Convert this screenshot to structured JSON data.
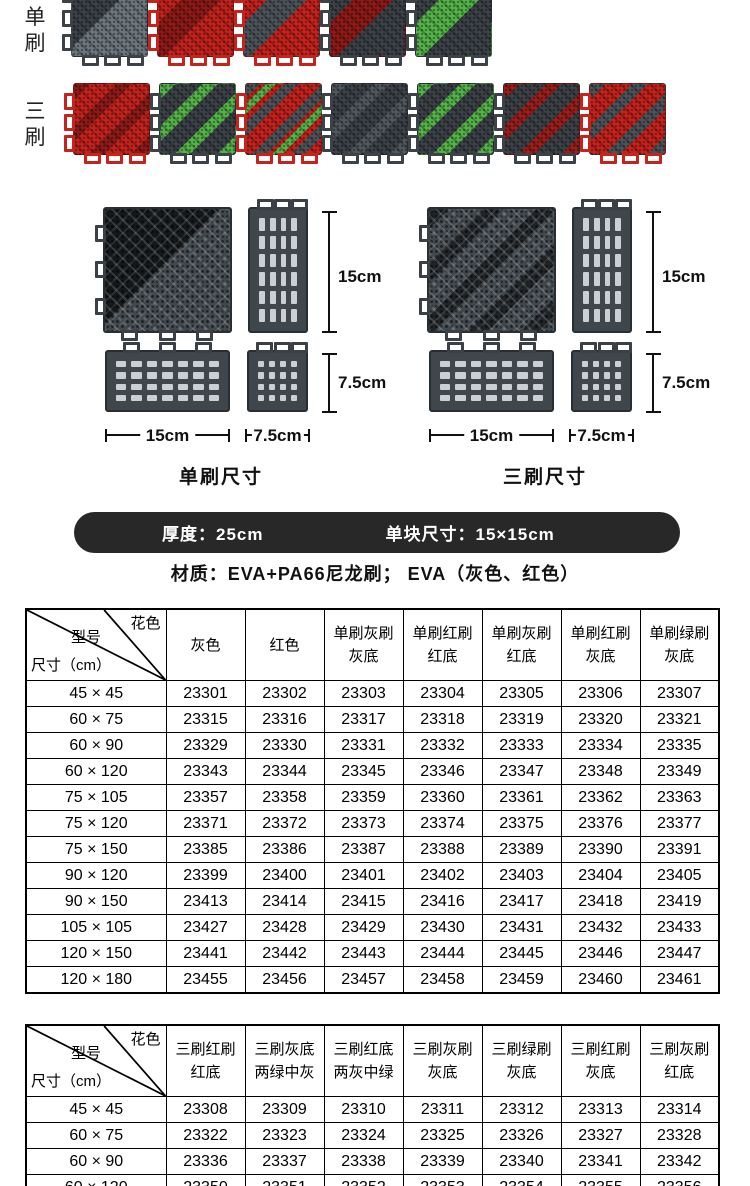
{
  "brush_sections": {
    "rows": [
      {
        "label": "单刷",
        "tiles": [
          {
            "name": "single-gray-gray-brush",
            "base": "#3c4247",
            "accent": "#6d777e",
            "style": "half"
          },
          {
            "name": "single-red-red-brush",
            "base": "#c7231d",
            "accent": "#8f1b18",
            "style": "band"
          },
          {
            "name": "single-red-gray-brush",
            "base": "#c7231d",
            "accent": "#4c545a",
            "style": "band"
          },
          {
            "name": "single-gray-red-brush",
            "base": "#3c4247",
            "accent": "#8f1b18",
            "style": "band"
          },
          {
            "name": "single-gray-green-brush",
            "base": "#3c4247",
            "accent": "#55b44a",
            "style": "band"
          }
        ]
      },
      {
        "label": "三刷",
        "tiles": [
          {
            "name": "triple-red-red-brush",
            "base": "#c7231d",
            "accent": "#8f1b18",
            "style": "stripes"
          },
          {
            "name": "triple-gray-green-brush",
            "base": "#3c4247",
            "accent": "#55b44a",
            "style": "stripes"
          },
          {
            "name": "triple-red-gray-green-brush",
            "base": "#c7231d",
            "accent": "#4c545a",
            "accent2": "#55b44a",
            "style": "stripes2"
          },
          {
            "name": "triple-gray-gray-brush",
            "base": "#3c4247",
            "accent": "#51595f",
            "style": "stripes"
          },
          {
            "name": "triple-gray-green-wide-brush",
            "base": "#3c4247",
            "accent": "#55b44a",
            "style": "stripes"
          },
          {
            "name": "triple-gray-red-brush",
            "base": "#3c4247",
            "accent": "#9c1f1c",
            "style": "stripes"
          },
          {
            "name": "triple-red-gray-brush",
            "base": "#c7231d",
            "accent": "#4c545a",
            "style": "stripes"
          }
        ]
      }
    ]
  },
  "diagrams": [
    {
      "caption": "单刷尺寸",
      "height_label": "15cm",
      "height2_label": "7.5cm",
      "width_label": "15cm",
      "width2_label": "7.5cm"
    },
    {
      "caption": "三刷尺寸",
      "height_label": "15cm",
      "height2_label": "7.5cm",
      "width_label": "15cm",
      "width2_label": "7.5cm"
    }
  ],
  "spec_bar": {
    "thickness": "厚度：25cm",
    "unit_size": "单块尺寸：15×15cm",
    "bg": "#282828",
    "text_color": "#ffffff"
  },
  "material_line": "材质：EVA+PA66尼龙刷；  EVA（灰色、红色）",
  "table_single": {
    "corner": {
      "top_right": "花色",
      "middle": "型号",
      "bottom_left": "尺寸（cm）"
    },
    "columns": [
      [
        "灰色",
        ""
      ],
      [
        "红色",
        ""
      ],
      [
        "单刷灰刷",
        "灰底"
      ],
      [
        "单刷红刷",
        "红底"
      ],
      [
        "单刷灰刷",
        "红底"
      ],
      [
        "单刷红刷",
        "灰底"
      ],
      [
        "单刷绿刷",
        "灰底"
      ]
    ],
    "rows": [
      {
        "size": "45 × 45",
        "codes": [
          "23301",
          "23302",
          "23303",
          "23304",
          "23305",
          "23306",
          "23307"
        ]
      },
      {
        "size": "60 × 75",
        "codes": [
          "23315",
          "23316",
          "23317",
          "23318",
          "23319",
          "23320",
          "23321"
        ]
      },
      {
        "size": "60 × 90",
        "codes": [
          "23329",
          "23330",
          "23331",
          "23332",
          "23333",
          "23334",
          "23335"
        ]
      },
      {
        "size": "60 × 120",
        "codes": [
          "23343",
          "23344",
          "23345",
          "23346",
          "23347",
          "23348",
          "23349"
        ]
      },
      {
        "size": "75 × 105",
        "codes": [
          "23357",
          "23358",
          "23359",
          "23360",
          "23361",
          "23362",
          "23363"
        ]
      },
      {
        "size": "75 × 120",
        "codes": [
          "23371",
          "23372",
          "23373",
          "23374",
          "23375",
          "23376",
          "23377"
        ]
      },
      {
        "size": "75 × 150",
        "codes": [
          "23385",
          "23386",
          "23387",
          "23388",
          "23389",
          "23390",
          "23391"
        ]
      },
      {
        "size": "90 × 120",
        "codes": [
          "23399",
          "23400",
          "23401",
          "23402",
          "23403",
          "23404",
          "23405"
        ]
      },
      {
        "size": "90 × 150",
        "codes": [
          "23413",
          "23414",
          "23415",
          "23416",
          "23417",
          "23418",
          "23419"
        ]
      },
      {
        "size": "105 × 105",
        "codes": [
          "23427",
          "23428",
          "23429",
          "23430",
          "23431",
          "23432",
          "23433"
        ]
      },
      {
        "size": "120 × 150",
        "codes": [
          "23441",
          "23442",
          "23443",
          "23444",
          "23445",
          "23446",
          "23447"
        ]
      },
      {
        "size": "120 × 180",
        "codes": [
          "23455",
          "23456",
          "23457",
          "23458",
          "23459",
          "23460",
          "23461"
        ]
      }
    ]
  },
  "table_triple": {
    "corner": {
      "top_right": "花色",
      "middle": "型号",
      "bottom_left": "尺寸（cm）"
    },
    "columns": [
      [
        "三刷红刷",
        "红底"
      ],
      [
        "三刷灰底",
        "两绿中灰"
      ],
      [
        "三刷红底",
        "两灰中绿"
      ],
      [
        "三刷灰刷",
        "灰底"
      ],
      [
        "三刷绿刷",
        "灰底"
      ],
      [
        "三刷红刷",
        "灰底"
      ],
      [
        "三刷灰刷",
        "红底"
      ]
    ],
    "rows": [
      {
        "size": "45 × 45",
        "codes": [
          "23308",
          "23309",
          "23310",
          "23311",
          "23312",
          "23313",
          "23314"
        ]
      },
      {
        "size": "60 × 75",
        "codes": [
          "23322",
          "23323",
          "23324",
          "23325",
          "23326",
          "23327",
          "23328"
        ]
      },
      {
        "size": "60 × 90",
        "codes": [
          "23336",
          "23337",
          "23338",
          "23339",
          "23340",
          "23341",
          "23342"
        ]
      },
      {
        "size": "60 × 120",
        "codes": [
          "23350",
          "23351",
          "23352",
          "23353",
          "23354",
          "23355",
          "23356"
        ]
      }
    ]
  }
}
